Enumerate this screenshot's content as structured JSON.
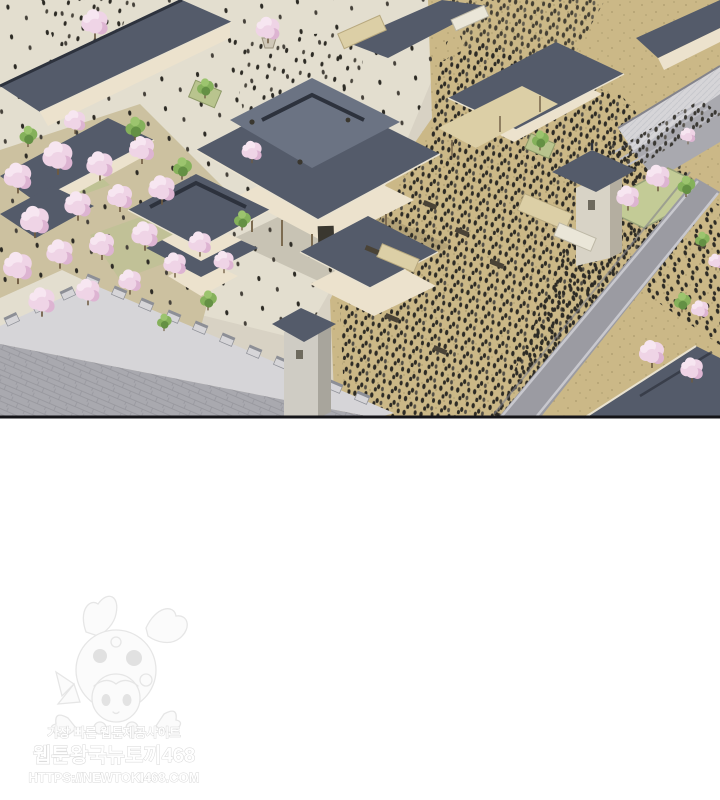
{
  "panel": {
    "kind": "webtoon-illustration-panel",
    "description": "Isometric aerial view of a traditional palace town: slate-roofed halls, cherry-blossom orchards, a crenellated stone city wall with gate towers, and a market square crowded with people",
    "border_color": "#141418"
  },
  "scene": {
    "palette": {
      "pavement": "#d8d2c4",
      "pavementLight": "#e3decf",
      "tan": "#cbb887",
      "speck": "#b3a274",
      "roof": "#545b6a",
      "roofDark": "#2d323d",
      "roofLight": "#6b7383",
      "eave": "#e9e2d0",
      "cream": "#ece2cd",
      "post": "#7c6b50",
      "stone": "#a9a9af",
      "stoneLight": "#d6d5d8",
      "stoneDark": "#8d8f96",
      "grass": "#b4c28b",
      "leaf": "#85b15b",
      "leafDark": "#649044",
      "leafLight": "#9cc46e",
      "blossom": "#efd4e6",
      "blossomLight": "#f7e6f1",
      "blossomDeep": "#ddb4d2",
      "trunk": "#6e5b41",
      "road": "#9b9ba2",
      "roadEdge": "#c8c8ce",
      "crowd": "#2d2b25",
      "awning": "#dccfa6",
      "ink": "#141418",
      "wmStroke": "#d6d6d6",
      "wmLine": "#e4e4e4"
    }
  },
  "watermark": {
    "tagline": "가장 빠른 웹툰제공사이트",
    "site_name": "웹툰왕국뉴토끼468",
    "site_url": "HTTPS://NEWTOKI468.COM",
    "mascot": "bunny-hood-girl-mascot"
  }
}
